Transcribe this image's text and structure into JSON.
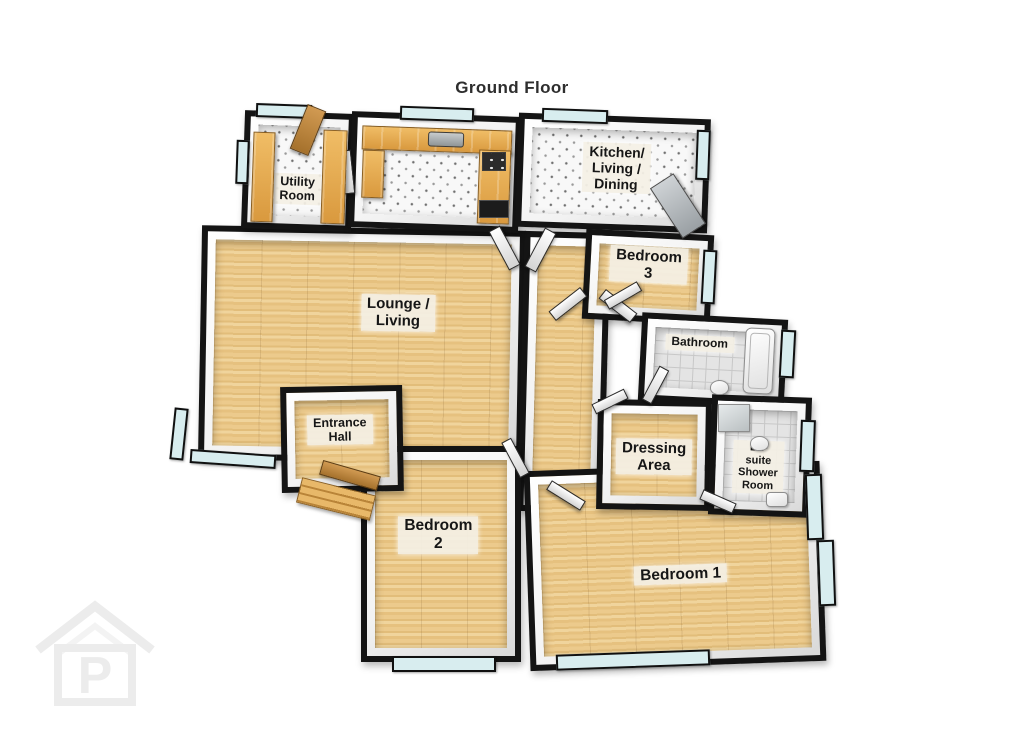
{
  "title": "Ground Floor",
  "watermark": {
    "letter": "P",
    "description": "house-outline-logo-watermark",
    "color": "#ececec"
  },
  "colors": {
    "wall": "#141414",
    "wood_floor": "#e9c685",
    "wood_counter": "#e2a34f",
    "kitchen_floor_speckled": "#f8f8f8",
    "tile_floor": "#e4e4e4",
    "window_glass": "#d8edef",
    "label_background": "#f2eee3",
    "text": "#161616"
  },
  "rooms": [
    {
      "id": "utility-room",
      "label_lines": [
        "Utility",
        "Room"
      ]
    },
    {
      "id": "kitchen-living-dining",
      "label_lines": [
        "Kitchen/",
        "Living /",
        "Dining"
      ]
    },
    {
      "id": "lounge-living",
      "label_lines": [
        "Lounge /",
        "Living"
      ]
    },
    {
      "id": "bedroom-3",
      "label_lines": [
        "Bedroom 3"
      ]
    },
    {
      "id": "bathroom",
      "label_lines": [
        "Bathroom"
      ]
    },
    {
      "id": "entrance-hall",
      "label_lines": [
        "Entrance",
        "Hall"
      ]
    },
    {
      "id": "dressing-area",
      "label_lines": [
        "Dressing",
        "Area"
      ]
    },
    {
      "id": "ensuite-shower-room",
      "label_lines": [
        "En-suite",
        "Shower",
        "Room"
      ]
    },
    {
      "id": "bedroom-2",
      "label_lines": [
        "Bedroom 2"
      ]
    },
    {
      "id": "bedroom-1",
      "label_lines": [
        "Bedroom 1"
      ]
    }
  ],
  "fixtures": [
    "kitchen-sink",
    "kitchen-hob",
    "kitchen-oven",
    "utility-counters",
    "bathtub",
    "toilet",
    "shower-tray",
    "wash-basin",
    "front-door",
    "entrance-steps"
  ]
}
